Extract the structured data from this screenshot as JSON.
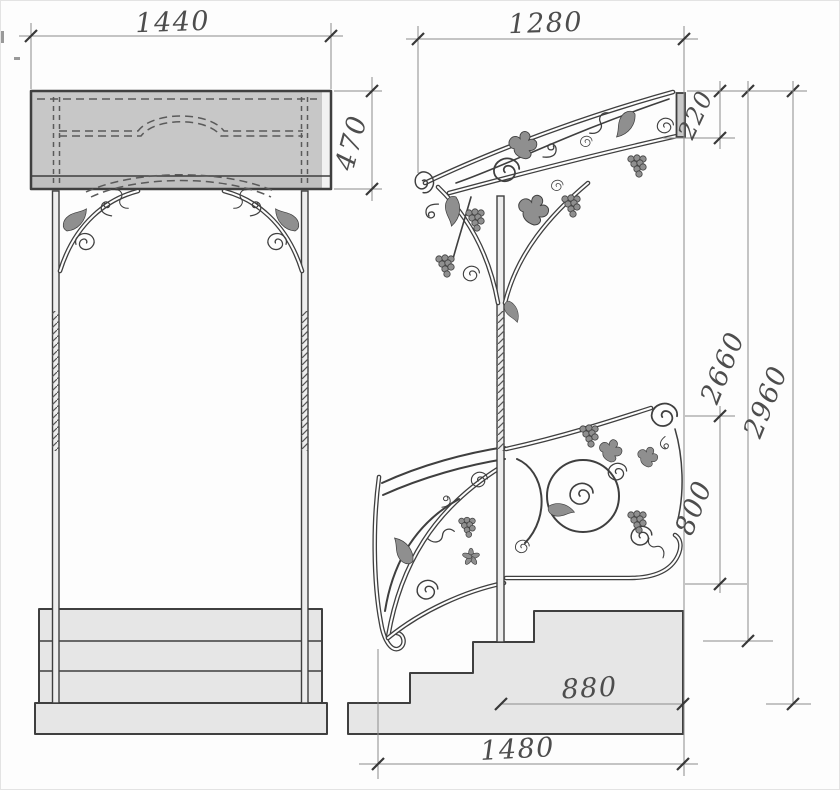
{
  "drawing": {
    "dimensions": {
      "front_overall_width": "1440",
      "front_canopy_height": "470",
      "side_canopy_projection": "1280",
      "side_canopy_edge_height": "220",
      "side_height_to_landing": "2660",
      "side_overall_height": "2960",
      "side_railing_height": "800",
      "side_landing_depth": "880",
      "side_stair_run": "1480"
    },
    "colors": {
      "paper": "#fdfdfd",
      "canopy_fill": "#c7c7c7",
      "fascia_fill": "#bfbfbf",
      "steps_fill": "#e6e6e6",
      "post_fill": "#ededed",
      "ink": "#3f3f3f",
      "dim_ink": "#8c8c8c",
      "label_ink": "#4d4d4d",
      "ornament_fill": "#8f8f8f"
    }
  }
}
